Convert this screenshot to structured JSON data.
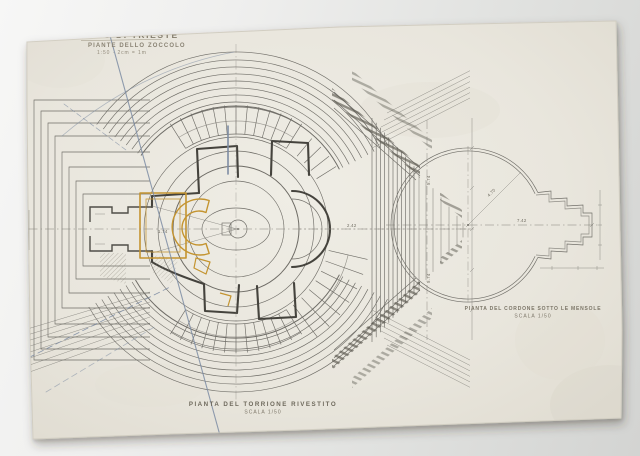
{
  "artwork": {
    "kind": "photographed architectural drawing",
    "title_block": {
      "line1": "FARO DI TRIESTE",
      "line2": "PIANTE DELLO ZOCCOLO",
      "line3": "1:50 · 2cm = 1m"
    },
    "captions": {
      "main_plan": {
        "line1": "PIANTA DEL TORRIONE RIVESTITO",
        "line2": "SCALA 1/50"
      },
      "side_plan": {
        "line1": "PIANTA DEL CORDONE SOTTO LE MENSOLE",
        "line2": "SCALA 1/50"
      }
    },
    "dimensions": {
      "room": "1.74",
      "flank_mid": "2.42",
      "flank_top": "5.74",
      "flank_bottom": "5.74",
      "radius_diag": "4.70",
      "radius_horiz": "7.42"
    },
    "colors": {
      "paper": "#e9e6dd",
      "backdrop": "#e2e3e1",
      "graphite": "#55534d",
      "ink_blue": "#7d8ca3",
      "accent_ochre": "#c49430"
    }
  }
}
